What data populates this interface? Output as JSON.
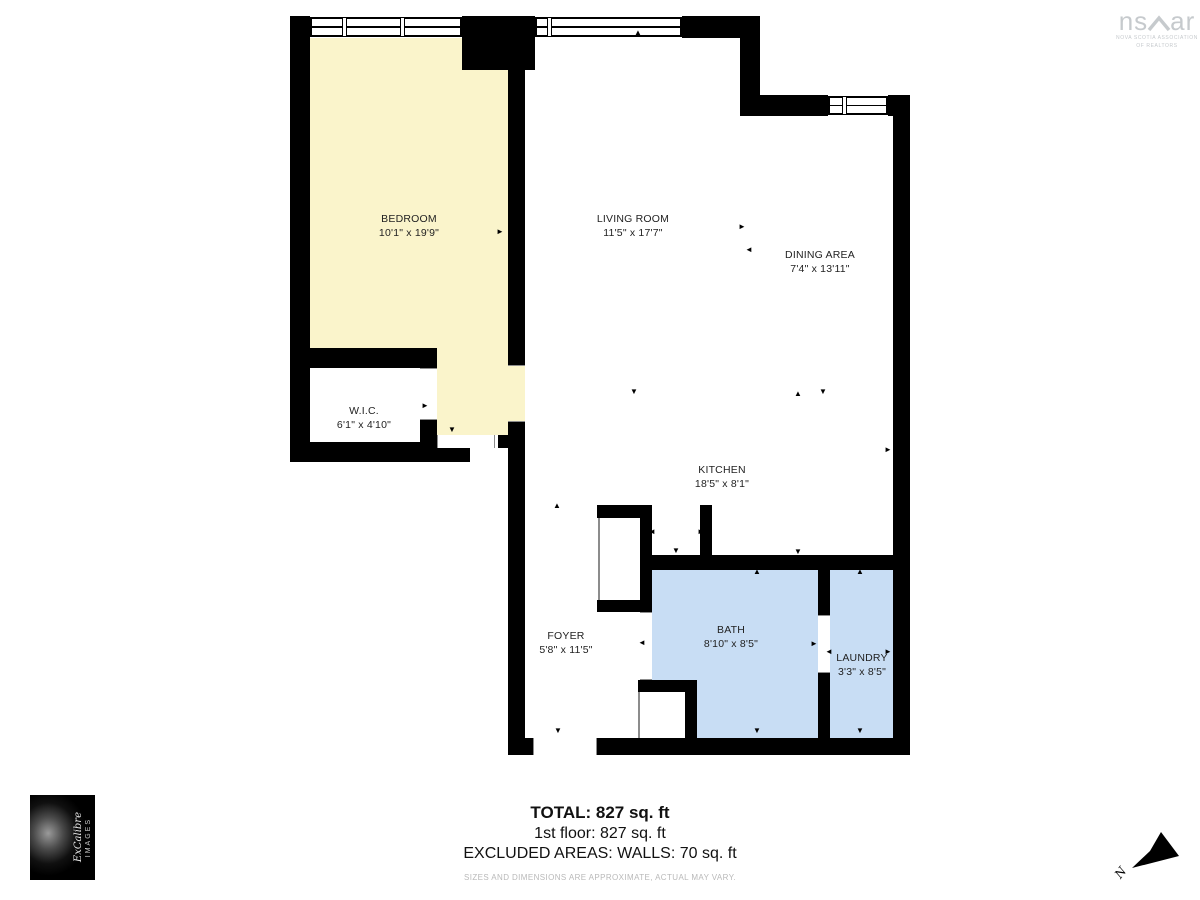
{
  "page": {
    "background": "#ffffff"
  },
  "branding": {
    "nsar": {
      "prefix": "ns",
      "suffix": "ar",
      "subline1": "NOVA SCOTIA ASSOCIATION",
      "subline2": "OF REALTORS",
      "color": "#c6cacd"
    },
    "photo_credit": {
      "brand": "ExCalibre",
      "word": "IMAGES"
    },
    "north": {
      "label": "N"
    }
  },
  "rooms": [
    {
      "key": "bedroom",
      "name": "BEDROOM",
      "dims": "10'1\" x 19'9\"",
      "fill": "#faf4cb"
    },
    {
      "key": "living",
      "name": "LIVING ROOM",
      "dims": "11'5\" x 17'7\"",
      "fill": "#ffffff"
    },
    {
      "key": "dining",
      "name": "DINING AREA",
      "dims": "7'4\" x 13'11\"",
      "fill": "#ffffff"
    },
    {
      "key": "wic",
      "name": "W.I.C.",
      "dims": "6'1\" x 4'10\"",
      "fill": "#ffffff"
    },
    {
      "key": "kitchen",
      "name": "KITCHEN",
      "dims": "18'5\" x 8'1\"",
      "fill": "#ffffff"
    },
    {
      "key": "foyer",
      "name": "FOYER",
      "dims": "5'8\" x 11'5\"",
      "fill": "#ffffff"
    },
    {
      "key": "bath",
      "name": "BATH",
      "dims": "8'10\" x 8'5\"",
      "fill": "#c8ddf4"
    },
    {
      "key": "laundry",
      "name": "LAUNDRY",
      "dims": "3'3\" x 8'5\"",
      "fill": "#c8ddf4"
    }
  ],
  "summary": {
    "total": "TOTAL: 827 sq. ft",
    "floor": "1st floor: 827 sq. ft",
    "excluded": "EXCLUDED AREAS: WALLS: 70 sq. ft",
    "disclaimer": "SIZES AND DIMENSIONS ARE APPROXIMATE, ACTUAL MAY VARY."
  },
  "colors": {
    "wall": "#000000",
    "window_line": "#000000",
    "door_line": "#8c8c8c",
    "arrow": "#000000",
    "yellow": "#faf4cb",
    "blue": "#c8ddf4"
  }
}
